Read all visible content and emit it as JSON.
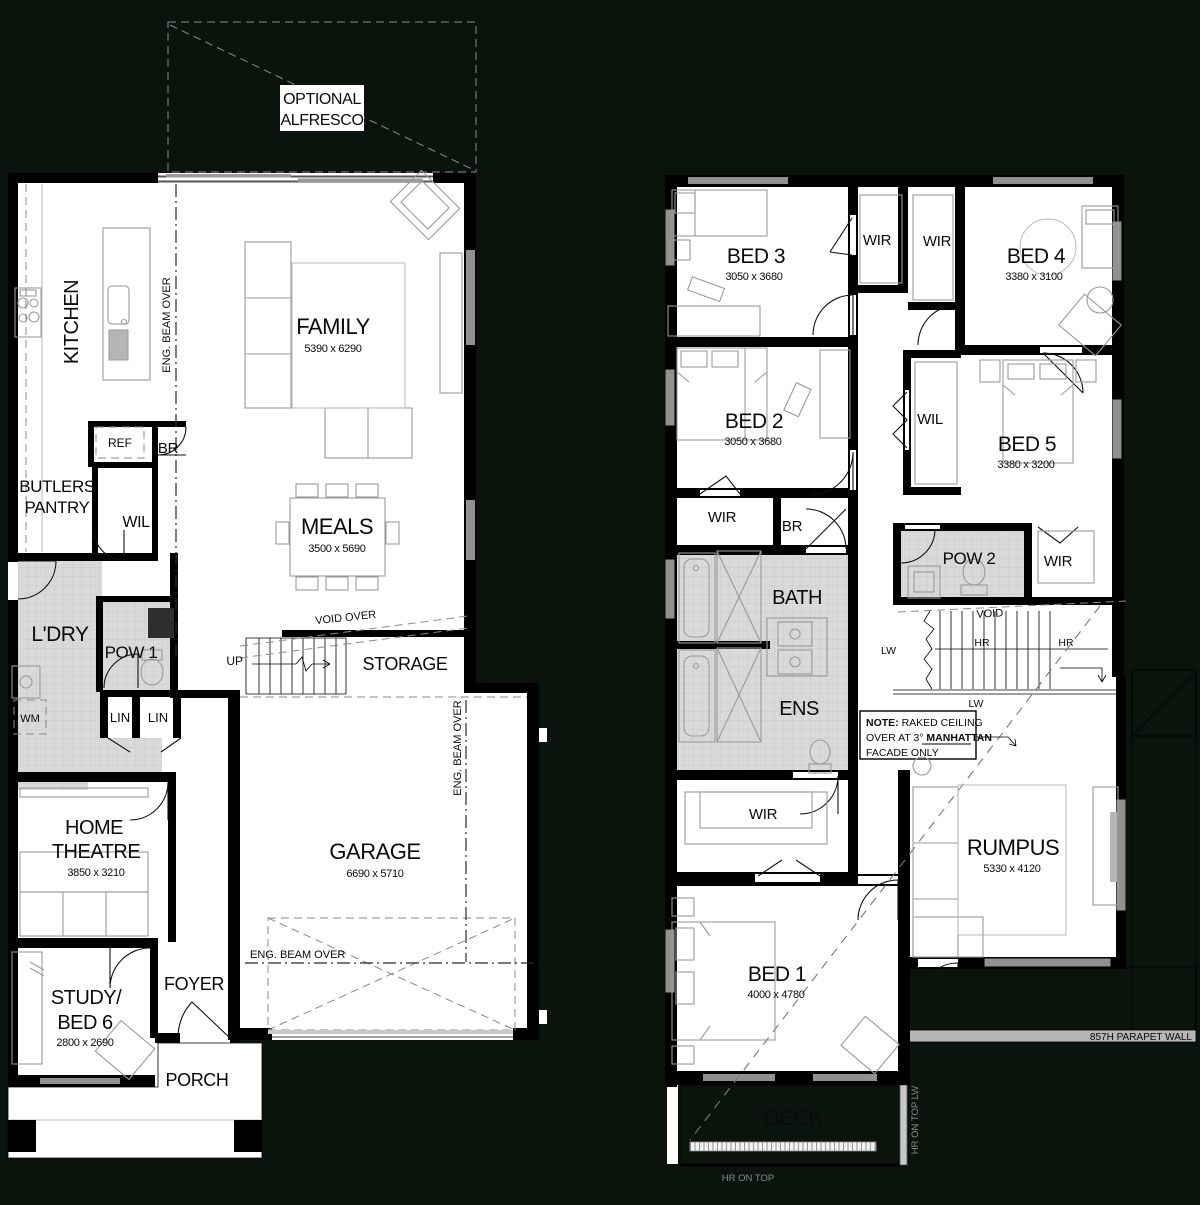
{
  "ground_floor": {
    "alfresco": {
      "line1": "OPTIONAL",
      "line2": "ALFRESCO"
    },
    "kitchen": "KITCHEN",
    "eng_beam_1": "ENG. BEAM OVER",
    "eng_beam_2": "ENG. BEAM OVER",
    "eng_beam_3": "ENG. BEAM OVER",
    "family": {
      "name": "FAMILY",
      "dims": "5390 x 6290"
    },
    "meals": {
      "name": "MEALS",
      "dims": "3500 x 5690"
    },
    "ref": "REF",
    "br": "BR",
    "butlers_pantry": {
      "line1": "BUTLERS",
      "line2": "PANTRY"
    },
    "wil": "WIL",
    "ldry": "L'DRY",
    "pow1": "POW 1",
    "wm": "WM",
    "lin1": "LIN",
    "lin2": "LIN",
    "void_over": "VOID OVER",
    "up": "UP",
    "storage": "STORAGE",
    "garage": {
      "name": "GARAGE",
      "dims": "6690 x 5710"
    },
    "home_theatre": {
      "line1": "HOME",
      "line2": "THEATRE",
      "dims": "3850 x 3210"
    },
    "study": {
      "line1": "STUDY/",
      "line2": "BED 6",
      "dims": "2800 x 2690"
    },
    "foyer": "FOYER",
    "porch": "PORCH"
  },
  "upper_floor": {
    "bed1": {
      "name": "BED 1",
      "dims": "4000 x 4780"
    },
    "bed2": {
      "name": "BED 2",
      "dims": "3050 x 3680"
    },
    "bed3": {
      "name": "BED 3",
      "dims": "3050 x 3680"
    },
    "bed4": {
      "name": "BED 4",
      "dims": "3380 x 3100"
    },
    "bed5": {
      "name": "BED 5",
      "dims": "3380 x 3200"
    },
    "wir_bed3": "WIR",
    "wir_bed4": "WIR",
    "wil": "WIL",
    "wir_bed2": "WIR",
    "br": "BR",
    "bath": "BATH",
    "ens": "ENS",
    "pow2": "POW 2",
    "wir_hall": "WIR",
    "wir_bed1": "WIR",
    "rumpus": {
      "name": "RUMPUS",
      "dims": "5330 x 4120"
    },
    "deck": "DECK",
    "void": "VOID",
    "lw_left": "LW",
    "hr_mid": "HR",
    "hr_right": "HR",
    "lw_bottom": "LW",
    "note": {
      "label": "NOTE:",
      "line1_rest": " RAKED CEILING",
      "line2_prefix": "OVER AT 3° ",
      "line2_bold": "MANHATTAN",
      "line3": "FACADE ONLY"
    },
    "parapet": "857H PARAPET WALL",
    "hr_on_top": "HR ON TOP",
    "hr_on_top_lw": "HR ON TOP LW"
  }
}
